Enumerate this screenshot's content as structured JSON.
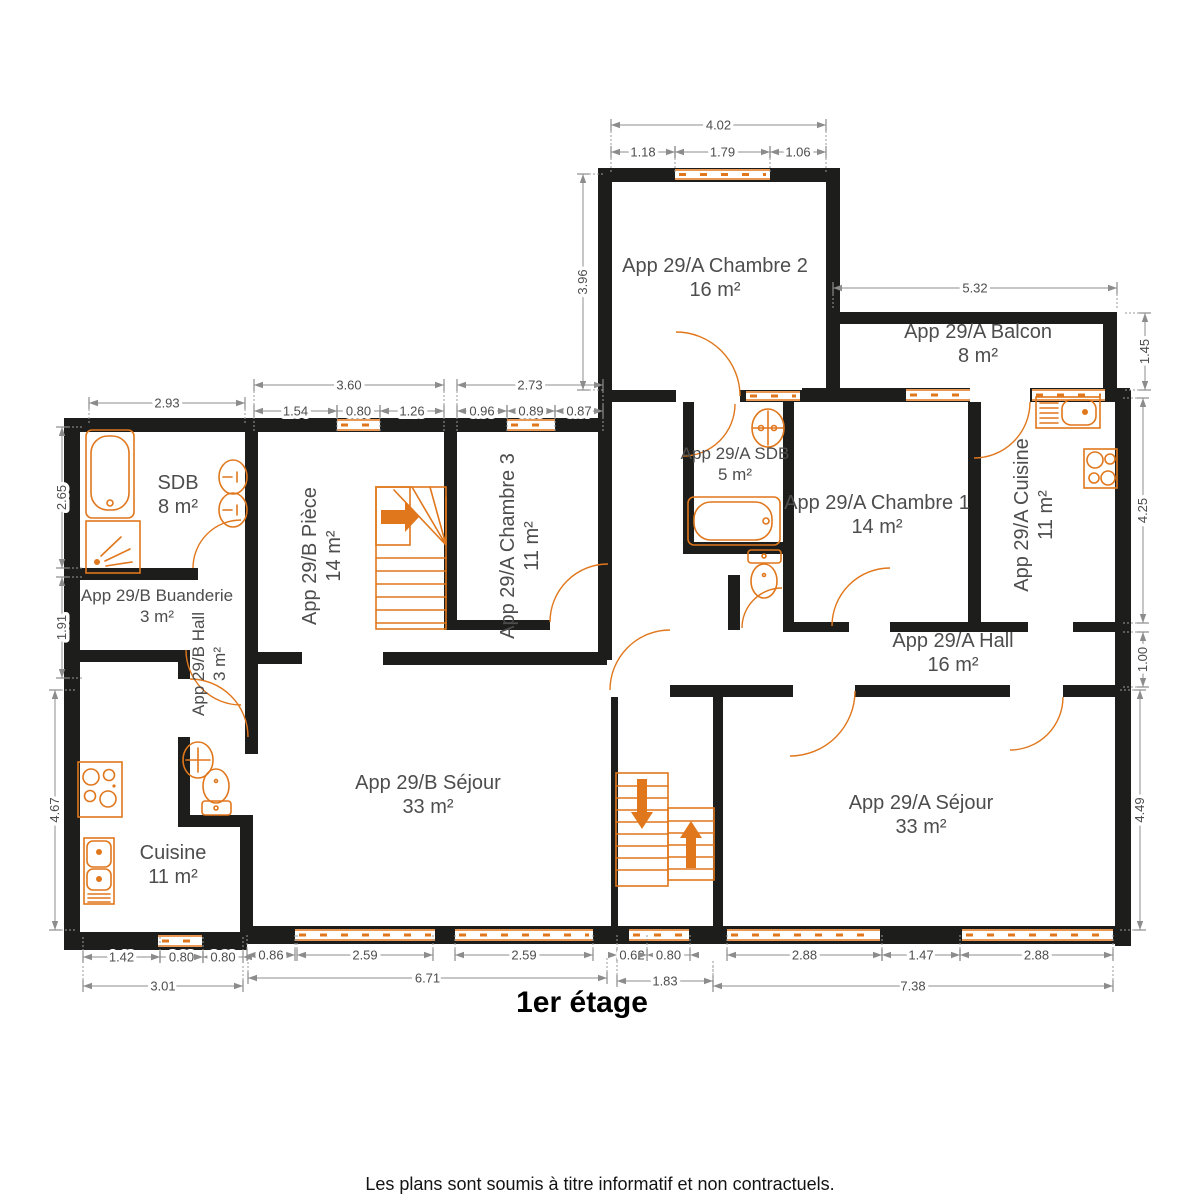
{
  "title": "1er étage",
  "footer": "Les plans sont soumis à titre informatif et non contractuels.",
  "colors": {
    "wall": "#1d1d1b",
    "accent": "#e0771c",
    "dim_line": "#8c8c8c",
    "dim_text": "#4d4d4d",
    "room_text": "#4d4d4d"
  },
  "rooms": [
    {
      "name": "App 29/A Chambre 2",
      "area": "16 m²",
      "x": 715,
      "y": 272,
      "rot": 0,
      "size": 20
    },
    {
      "name": "App 29/A Balcon",
      "area": "8 m²",
      "x": 978,
      "y": 338,
      "rot": 0,
      "size": 20
    },
    {
      "name": "SDB",
      "area": "8 m²",
      "x": 178,
      "y": 489,
      "rot": 0,
      "size": 20
    },
    {
      "name": "App 29/A SDB",
      "area": "5 m²",
      "x": 735,
      "y": 459,
      "rot": 0,
      "size": 17
    },
    {
      "name": "App 29/A Chambre 1",
      "area": "14 m²",
      "x": 877,
      "y": 509,
      "rot": 0,
      "size": 20
    },
    {
      "name": "App 29/A Cuisine",
      "area": "11 m²",
      "x": 1028,
      "y": 515,
      "rot": -90,
      "size": 20
    },
    {
      "name": "App 29/B Buanderie",
      "area": "3 m²",
      "x": 157,
      "y": 601,
      "rot": 0,
      "size": 17
    },
    {
      "name": "App 29/B Hall",
      "area": "3 m²",
      "x": 204,
      "y": 664,
      "rot": -90,
      "size": 17
    },
    {
      "name": "App 29/B Pièce",
      "area": "14 m²",
      "x": 316,
      "y": 556,
      "rot": -90,
      "size": 20
    },
    {
      "name": "App 29/A Chambre 3",
      "area": "11 m²",
      "x": 514,
      "y": 546,
      "rot": -90,
      "size": 20
    },
    {
      "name": "App 29/A Hall",
      "area": "16 m²",
      "x": 953,
      "y": 647,
      "rot": 0,
      "size": 20
    },
    {
      "name": "App 29/B Séjour",
      "area": "33 m²",
      "x": 428,
      "y": 789,
      "rot": 0,
      "size": 20
    },
    {
      "name": "App 29/A Séjour",
      "area": "33 m²",
      "x": 921,
      "y": 809,
      "rot": 0,
      "size": 20
    },
    {
      "name": "Cuisine",
      "area": "11 m²",
      "x": 173,
      "y": 859,
      "rot": 0,
      "size": 20
    }
  ],
  "dimensions": {
    "horizontal": [
      {
        "label": "4.02",
        "x1": 611,
        "x2": 826,
        "y": 125
      },
      {
        "label": "1.18",
        "x1": 611,
        "x2": 675,
        "y": 152
      },
      {
        "label": "1.79",
        "x1": 675,
        "x2": 770,
        "y": 152
      },
      {
        "label": "1.06",
        "x1": 770,
        "x2": 826,
        "y": 152
      },
      {
        "label": "5.32",
        "x1": 833,
        "x2": 1117,
        "y": 288
      },
      {
        "label": "2.93",
        "x1": 89,
        "x2": 245,
        "y": 403
      },
      {
        "label": "3.60",
        "x1": 254,
        "x2": 444,
        "y": 385
      },
      {
        "label": "1.54",
        "x1": 254,
        "x2": 337,
        "y": 411
      },
      {
        "label": "0.80",
        "x1": 337,
        "x2": 380,
        "y": 411
      },
      {
        "label": "1.26",
        "x1": 380,
        "x2": 444,
        "y": 411
      },
      {
        "label": "2.73",
        "x1": 457,
        "x2": 603,
        "y": 385
      },
      {
        "label": "0.96",
        "x1": 457,
        "x2": 507,
        "y": 411
      },
      {
        "label": "0.89",
        "x1": 507,
        "x2": 555,
        "y": 411
      },
      {
        "label": "0.87",
        "x1": 555,
        "x2": 603,
        "y": 411
      },
      {
        "label": "1.42",
        "x1": 83,
        "x2": 160,
        "y": 957
      },
      {
        "label": "0.80",
        "x1": 160,
        "x2": 203,
        "y": 957
      },
      {
        "label": "0.80",
        "x1": 203,
        "x2": 243,
        "y": 957
      },
      {
        "label": "3.01",
        "x1": 83,
        "x2": 243,
        "y": 986
      },
      {
        "label": "0.86",
        "x1": 247,
        "x2": 295,
        "y": 955
      },
      {
        "label": "2.59",
        "x1": 297,
        "x2": 433,
        "y": 955
      },
      {
        "label": "2.59",
        "x1": 455,
        "x2": 593,
        "y": 955
      },
      {
        "label": "6.71",
        "x1": 248,
        "x2": 607,
        "y": 978
      },
      {
        "label": "0.62",
        "x1": 617,
        "x2": 647,
        "y": 955
      },
      {
        "label": "0.80",
        "x1": 647,
        "x2": 690,
        "y": 955
      },
      {
        "label": "1.83",
        "x1": 617,
        "x2": 713,
        "y": 981
      },
      {
        "label": "2.88",
        "x1": 727,
        "x2": 882,
        "y": 955
      },
      {
        "label": "1.47",
        "x1": 882,
        "x2": 960,
        "y": 955
      },
      {
        "label": "2.88",
        "x1": 960,
        "x2": 1113,
        "y": 955
      },
      {
        "label": "7.38",
        "x1": 713,
        "x2": 1113,
        "y": 986
      }
    ],
    "vertical": [
      {
        "label": "3.96",
        "x": 583,
        "y1": 174,
        "y2": 390
      },
      {
        "label": "1.45",
        "x": 1145,
        "y1": 313,
        "y2": 390
      },
      {
        "label": "2.65",
        "x": 62,
        "y1": 427,
        "y2": 568
      },
      {
        "label": "1.91",
        "x": 62,
        "y1": 577,
        "y2": 678
      },
      {
        "label": "4.67",
        "x": 55,
        "y1": 690,
        "y2": 930
      },
      {
        "label": "4.25",
        "x": 1143,
        "y1": 398,
        "y2": 623
      },
      {
        "label": "1.00",
        "x": 1143,
        "y1": 632,
        "y2": 687
      },
      {
        "label": "4.49",
        "x": 1140,
        "y1": 690,
        "y2": 930
      }
    ]
  }
}
